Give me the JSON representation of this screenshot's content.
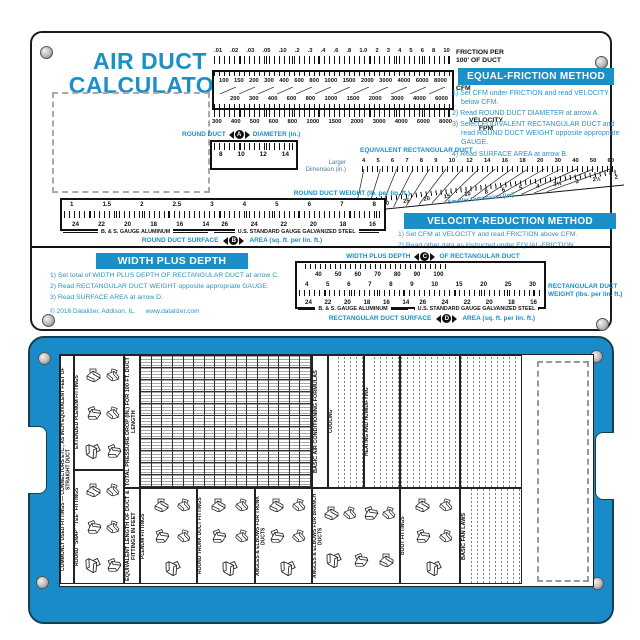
{
  "top_card": {
    "title_line1": "AIR DUCT",
    "title_line2": "CALCULATOR",
    "friction_scale": {
      "label_1": "FRICTION PER",
      "label_2": "100' OF DUCT",
      "values": [
        ".01",
        ".02",
        ".03",
        ".05",
        ".10",
        ".2",
        ".3",
        ".4",
        ".6",
        ".8",
        "1.0",
        "2",
        "3",
        "4",
        "5",
        "6",
        "8",
        "10"
      ]
    },
    "cfm_scale": {
      "label": "CFM",
      "row1": [
        "100",
        "150",
        "200",
        "300",
        "400",
        "600",
        "800",
        "1000",
        "1500",
        "2000",
        "3000",
        "4000",
        "6000",
        "8000"
      ],
      "row2": [
        "200",
        "300",
        "400",
        "600",
        "800",
        "1000",
        "1500",
        "2000",
        "3000",
        "4000",
        "6000"
      ]
    },
    "velocity_scale": {
      "label_1": "VELOCITY",
      "label_2": "FPM",
      "values": [
        "300",
        "400",
        "500",
        "600",
        "800",
        "1000",
        "1500",
        "2000",
        "3000",
        "4000",
        "6000",
        "8000"
      ]
    },
    "round_duct_diameter": {
      "label_left": "ROUND DUCT",
      "arrow": "A",
      "label_right": "DIAMETER (in.)",
      "values": [
        "8",
        "10",
        "12",
        "14"
      ]
    },
    "equal_friction": {
      "header": "EQUAL-FRICTION METHOD",
      "steps": [
        "1) Set CFM under FRICTION and read VELOCITY below CFM.",
        "2) Read ROUND DUCT DIAMETER at arrow A.",
        "3) Select EQUIVALENT RECTANGULAR DUCT and read ROUND DUCT WEIGHT opposite appropriate GAUGE.",
        "4) Read SURFACE AREA at arrow B."
      ]
    },
    "equivalent_rect": {
      "header": "EQUIVALENT RECTANGULAR DUCT",
      "larger_label_1": "Larger",
      "larger_label_2": "Dimension (in.)",
      "smaller_label": "Smaller Dimension (in.)",
      "larger_values": [
        "4",
        "5",
        "6",
        "7",
        "8",
        "9",
        "10",
        "12",
        "14",
        "16",
        "18",
        "20",
        "30",
        "40",
        "50",
        "60"
      ],
      "smaller_values": [
        "40",
        "35",
        "30",
        "25",
        "20",
        "15",
        "10",
        "8",
        "6",
        "5",
        "4",
        "3½",
        "3",
        "2½",
        "2"
      ]
    },
    "round_duct_weight": {
      "label": "ROUND DUCT WEIGHT (lb. per lin. ft.)",
      "values": [
        "1",
        "1.5",
        "2",
        "2.5",
        "3",
        "4",
        "5",
        "6",
        "7",
        "8"
      ],
      "alum_gauges": [
        "24",
        "22",
        "20",
        "18",
        "16",
        "14"
      ],
      "steel_gauges": [
        "26",
        "24",
        "22",
        "20",
        "18",
        "16"
      ],
      "alum_label": "B. & S. GAUGE ALUMINUM",
      "steel_label": "U.S. STANDARD GAUGE GALVANIZED STEEL"
    },
    "round_surface": {
      "left": "ROUND DUCT SURFACE",
      "arrow": "B",
      "right": "AREA (sq. ft. per lin. ft.)"
    },
    "velocity_reduction": {
      "header": "VELOCITY-REDUCTION METHOD",
      "steps": [
        "1) Set CFM at VELOCITY and read FRICTION above CFM.",
        "2) Read other data as instructed under EQUAL-FRICTION."
      ]
    },
    "width_plus_depth": {
      "header": "WIDTH PLUS DEPTH",
      "steps": [
        "1) Set total of WIDTH PLUS DEPTH OF RECTANGULAR DUCT at arrow C.",
        "2) Read RECTANGULAR DUCT WEIGHT opposite appropriate GAUGE.",
        "3) Read SURFACE AREA at arrow D."
      ],
      "copyright": "© 2016 Datalizer, Addison, IL.",
      "website": "www.datalizer.com"
    },
    "wpd_scale": {
      "label_left": "WIDTH PLUS DEPTH",
      "arrow": "C",
      "label_right": "OF RECTANGULAR DUCT",
      "top_values": [
        "40",
        "50",
        "60",
        "70",
        "80",
        "90",
        "100"
      ],
      "weight_values": [
        "4",
        "5",
        "6",
        "7",
        "8",
        "9",
        "10",
        "15",
        "20",
        "25",
        "30"
      ],
      "alum_gauges": [
        "24",
        "22",
        "20",
        "18",
        "16",
        "14"
      ],
      "steel_gauges": [
        "26",
        "24",
        "22",
        "20",
        "18",
        "16"
      ],
      "alum_label": "B. & S. GAUGE ALUMINUM",
      "steel_label": "U.S. STANDARD GAUGE GALVANIZED STEEL",
      "right_label_1": "RECTANGULAR DUCT",
      "right_label_2": "WEIGHT (lbs. per lin. ft.)"
    },
    "rect_surface": {
      "left": "RECTANGULAR DUCT SURFACE",
      "arrow": "D",
      "right": "AREA (sq. ft. per lin. ft.)"
    }
  },
  "bottom_card": {
    "left_strip": "COMMONLY USED FITTINGS — CONNECTORS ETC., AS INCH EQUIVALENT FEET OF STRAIGHT DUCT",
    "pressure_table_label": "TOTAL PRESSURE DROP (IN.) FOR 100 FT. DUCT LENGTH",
    "equivalent_length_label": "EQUIVALENT LENGTH OF DUCT & FITTINGS IN FEET",
    "formulas_header": "BASIC AIR CONDITIONING FORMULAS",
    "cooling": "COOLING",
    "heating": "HEATING AND HUMIDIFYING",
    "fan_laws": "BASIC FAN LAWS",
    "panels": {
      "ext_plenum": "EXTENDED PLENUM FITTINGS",
      "snap_tee": "ROUND \"SNAP\" \"TEE\" FITTINGS",
      "plenum": "PLENUM FITTINGS",
      "round_trunk": "ROUND TRUNK DUCT FITTINGS",
      "angles_trunk": "ANGLES & ELBOWS FOR TRUNK DUCTS",
      "angles_branch": "ANGLES & ELBOWS FOR BRANCH DUCTS",
      "boot": "BOOT FITTINGS"
    }
  }
}
